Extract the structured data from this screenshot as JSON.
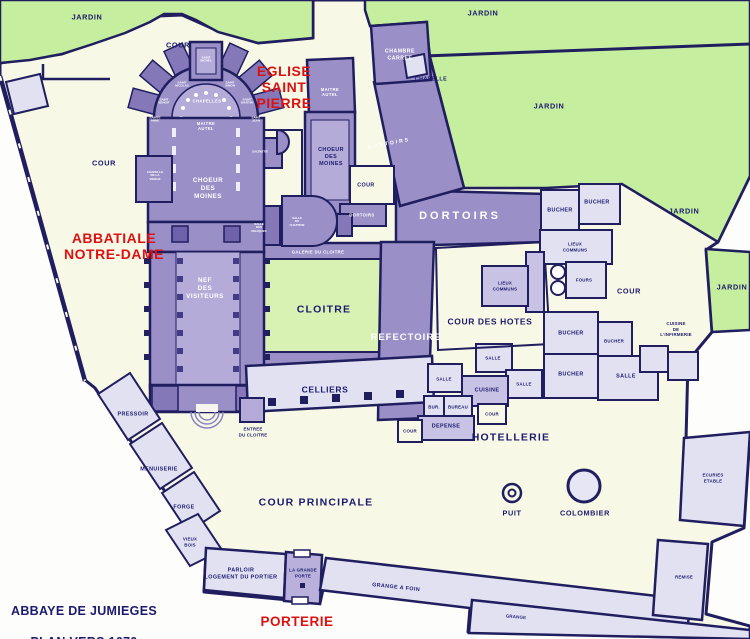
{
  "map_title": {
    "line1": "ABBAYE DE JUMIEGES",
    "line2": "PLAN VERS 1670"
  },
  "colors": {
    "paper": "#fdfdfb",
    "enclosure_cream": "#f8f8e6",
    "garden_green": "#c5ee9e",
    "cloister_lawn_green": "#d7f2b2",
    "building_purple": "#9a90c7",
    "building_purple_light": "#b4abd9",
    "building_purple_dark": "#8478b8",
    "room_light_lavender": "#e2e1f2",
    "room_mid_lavender": "#c8c3e5",
    "wall_navy": "#201e5f",
    "label_navy": "#1c1a6e",
    "label_red": "#dc1111",
    "label_white": "#ffffff"
  },
  "labels": {
    "jardin_nw": "JARDIN",
    "jardin_ne": "JARDIN",
    "jardin_east_upper": "JARDIN",
    "jardin_east_mid": "JARDIN",
    "jardin_east_lower": "JARDIN",
    "cour_north": "COUR",
    "cour_west": "COUR",
    "cour_saint_pierre": "COUR",
    "cour_east": "COUR",
    "cour_des_hotes": "COUR DES HOTES",
    "cour_principale": "COUR PRINCIPALE",
    "cour_pocket_1": "COUR",
    "cour_pocket_2": "COUR",
    "eglise_saint_pierre": "EGLISE\nSAINT\nPIERRE",
    "abbatiale_notre_dame": "ABBATIALE\nNOTRE-DAME",
    "porterie": "PORTERIE",
    "chambre_carree": "CHAMBRE\nCARREE",
    "chapelle": "CHAPELLE",
    "chapelles": "CHAPELLES",
    "maitre_autel_nd": "MAITRE\nAUTEL",
    "maitre_autel_sp": "MAITRE\nAUTEL",
    "choeur_des_moines_nd": "CHOEUR\nDES\nMOINES",
    "choeur_des_moines_sp": "CHOEUR\nDES\nMOINES",
    "nef_des_visiteurs": "NEF\nDES\nVISITEURS",
    "sacristie": "SACRISTIE",
    "chapelle_de_la_vierge": "CHAPELLE\nDE LA\nVIERGE",
    "chapel_axial": "SAINT\nMICHEL",
    "chapel_left_1": "SAINT\nNICOLAS",
    "chapel_left_2": "SAINT\nBENOIT",
    "chapel_left_3": "SAINTE\nANNE",
    "chapel_right_1": "SAINT\nSIMON",
    "chapel_right_2": "SAINT\nMARTIN",
    "chapel_right_3": "SAINT\nJEAN",
    "salle_du_chapitre": "SALLE\nDU\nCHAPITRE",
    "salle_des_reliques": "SALLE\nDES\nRELIQUES",
    "galerie_du_cloitre": "GALERIE DU CLOITRE",
    "cloitre": "CLOITRE",
    "refectoire": "REFECTOIRE",
    "dortoirs_main": "DORTOIRS",
    "dortoirs_diagonal": "DORTOIRS",
    "dortoirs_small": "DORTOIRS",
    "lieux_communs_east": "LIEUX\nCOMMUNS",
    "lieux_communs_west": "LIEUX\nCOMMUNS",
    "fours": "FOURS",
    "bucher_1": "BUCHER",
    "bucher_2": "BUCHER",
    "bucher_3": "BUCHER",
    "bucher_4": "BUCHER",
    "bucher_5": "BUCHER",
    "cuisine_infirmerie": "CUISINE\nDE\nL'INFIRMERIE",
    "salle_1": "SALLE",
    "salle_2": "SALLE",
    "salle_3": "SALLE",
    "salle_east": "SALLE",
    "cuisine": "CUISINE",
    "bur": "BUR.",
    "bureau": "BUREAU",
    "depense": "DEPENSE",
    "hotellerie": "HOTELLERIE",
    "celliers": "CELLIERS",
    "entree_du_cloitre": "ENTREE\nDU CLOITRE",
    "pressoir": "PRESSOIR",
    "menuiserie": "MENUISERIE",
    "forge": "FORGE",
    "vieux_bois": "VIEUX\nBOIS",
    "parloir": "PARLOIR\nLOGEMENT DU PORTIER",
    "la_grande_porte": "LA GRANDE\nPORTE",
    "grange_a_foin": "GRANGE A FOIN",
    "grange": "GRANGE",
    "remise": "REMISE",
    "ecuries_etable": "ECURIES\nETABLE",
    "puit": "PUIT",
    "colombier": "COLOMBIER"
  }
}
